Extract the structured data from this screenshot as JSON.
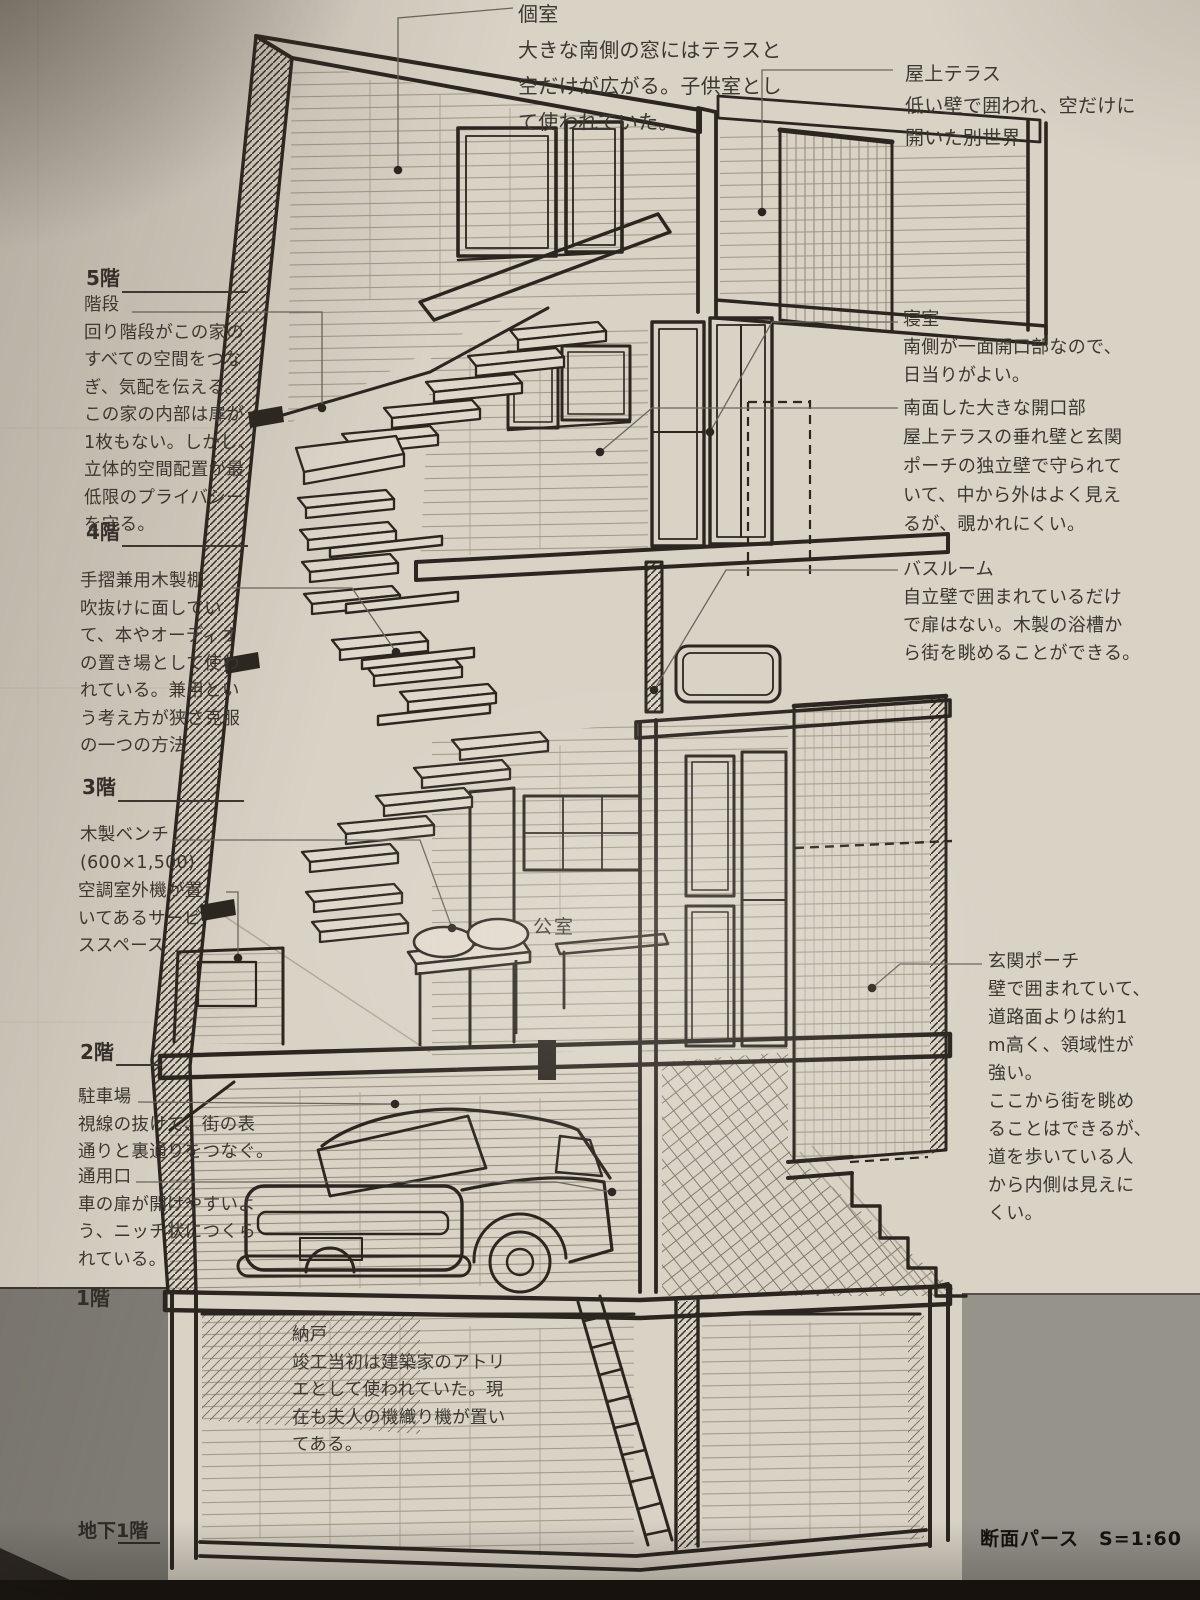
{
  "palette": {
    "paper": "#d9d3c6",
    "ink": "#2b2620",
    "pencil": "#9a927f",
    "text": "#3b3731",
    "ground_left": "#7e7b74",
    "ground_right": "#96938b",
    "page_edge": "#16120e"
  },
  "floors": {
    "f5": "5階",
    "f4": "4階",
    "f3": "3階",
    "f2": "2階",
    "f1": "1階",
    "b1": "地下1階"
  },
  "drawing": {
    "room_label": "公室",
    "caption": "断面パース　S=1:60"
  },
  "notes": {
    "kojitsu": {
      "title": "個室",
      "body": "大きな南側の窓にはテラスと\n空だけが広がる。子供室とし\nて使われていた。"
    },
    "okujo": {
      "title": "屋上テラス",
      "body": "低い壁で囲われ、空だけに\n開いた別世界"
    },
    "kaidan": {
      "title": "階段",
      "body": "回り階段がこの家の\nすべての空間をつな\nぎ、気配を伝える。\nこの家の内部は扉が\n1枚もない。しかし、\n立体的空間配置が最\n低限のプライバシー\nを守る。"
    },
    "tana": {
      "title": "手摺兼用木製棚",
      "body": "吹抜けに面してい\nて、本やオーディオ\nの置き場として使わ\nれている。兼用とい\nう考え方が狭さ克服\nの一つの方法"
    },
    "bench": {
      "title": "木製ベンチ",
      "body": "(600×1,500)"
    },
    "kucho": {
      "title": "",
      "body": "空調室外機が置\nいてあるサービ\nススペース"
    },
    "chusha": {
      "title": "駐車場",
      "body": "視線の抜けで、街の表\n通りと裏通りをつなぐ。"
    },
    "tsuyo": {
      "title": "通用口",
      "body": "車の扉が開けやすいよ\nう、ニッチ状につくら\nれている。"
    },
    "nando": {
      "title": "納戸",
      "body": "竣工当初は建築家のアトリ\nエとして使われていた。現\n在も夫人の機織り機が置い\nてある。"
    },
    "shinshitsu": {
      "title": "寝室",
      "body": "南側が一面開口部なので、\n日当りがよい。"
    },
    "kaikobu": {
      "title": "南面した大きな開口部",
      "body": "屋上テラスの垂れ壁と玄関\nポーチの独立壁で守られて\nいて、中から外はよく見え\nるが、覗かれにくい。"
    },
    "bathroom": {
      "title": "バスルーム",
      "body": "自立壁で囲まれているだけ\nで扉はない。木製の浴槽か\nら街を眺めることができる。"
    },
    "genkan": {
      "title": "玄関ポーチ",
      "body": "壁で囲まれていて、\n道路面よりは約1\nm高く、領域性が\n強い。\nここから街を眺め\nることはできるが、\n道を歩いている人\nから内側は見えに\nくい。"
    }
  }
}
